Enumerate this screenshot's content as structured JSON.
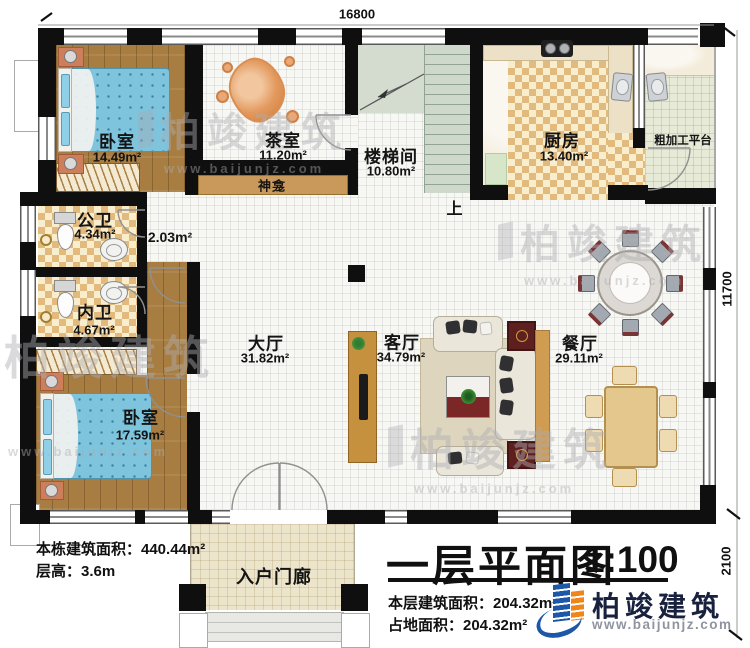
{
  "plan": {
    "dimensions": {
      "top": "16800",
      "right": "11700",
      "bottom_right": "2100"
    },
    "rooms": [
      {
        "name": "卧室",
        "area": "14.49m²"
      },
      {
        "name": "茶室",
        "area": "11.20m²"
      },
      {
        "name": "楼梯间",
        "area": "10.80m²"
      },
      {
        "name": "厨房",
        "area": "13.40m²"
      },
      {
        "name": "粗加工平台",
        "area": ""
      },
      {
        "name": "公卫",
        "area": "4.34m²"
      },
      {
        "name": "",
        "area": "2.03m²"
      },
      {
        "name": "内卫",
        "area": "4.67m²"
      },
      {
        "name": "卧室",
        "area": "17.59m²"
      },
      {
        "name": "大厅",
        "area": "31.82m²"
      },
      {
        "name": "客厅",
        "area": "34.79m²"
      },
      {
        "name": "餐厅",
        "area": "29.11m²"
      },
      {
        "name": "入户门廊",
        "area": ""
      },
      {
        "name": "神龛",
        "area": ""
      }
    ],
    "stairs_up": "上"
  },
  "info_left": {
    "line1": "本栋建筑面积：440.44m²",
    "line2": "层高：3.6m"
  },
  "title_block": {
    "title": "一层平面图",
    "scale": "1:100",
    "line1": "本层建筑面积：204.32m²",
    "line2": "占地面积：204.32m²"
  },
  "brand": {
    "name": "柏竣建筑",
    "url": "www.baijunjz.com"
  },
  "watermark": {
    "text": "柏竣建筑",
    "url": "www.baijunjz.com"
  },
  "colors": {
    "wall": "#0f0f0f",
    "wood": "#a87d41",
    "bed": "#7ec4dd",
    "brand_blue": "#1d57a8",
    "brand_orange": "#f08519"
  }
}
